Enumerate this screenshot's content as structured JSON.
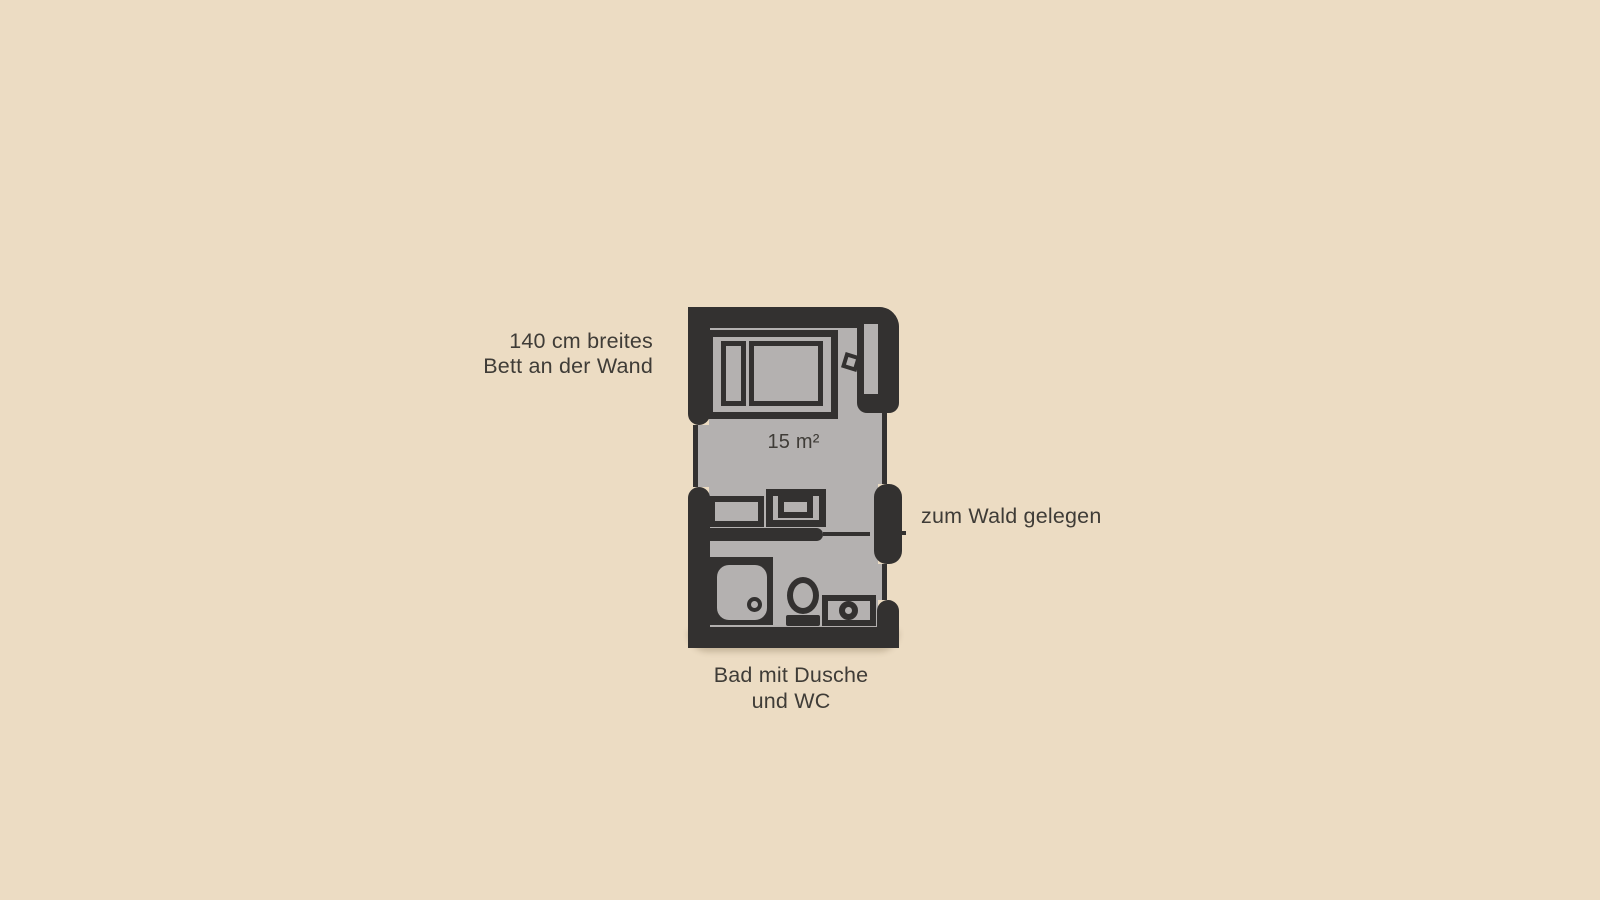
{
  "canvas": {
    "background": "#ecdcc3"
  },
  "colors": {
    "bg": "#ecdcc3",
    "wall": "#333130",
    "floor": "#b4b1b0",
    "text": "#3f3c37"
  },
  "floorplan": {
    "area_label": "15 m²",
    "annotations": {
      "bed_line1": "140 cm breites",
      "bed_line2": "Bett an der Wand",
      "window": "zum Wald gelegen",
      "bath_line1": "Bad mit Dusche",
      "bath_line2": "und WC"
    }
  }
}
